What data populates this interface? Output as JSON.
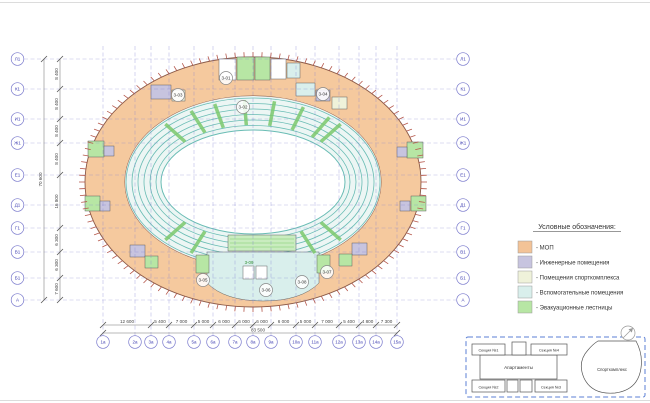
{
  "plan": {
    "rows": [
      {
        "label": "Л1",
        "y": 59
      },
      {
        "label": "К1",
        "y": 89
      },
      {
        "label": "И1",
        "y": 119
      },
      {
        "label": "Ж1",
        "y": 143
      },
      {
        "label": "Е1",
        "y": 175
      },
      {
        "label": "Д1",
        "y": 205
      },
      {
        "label": "Г1",
        "y": 228
      },
      {
        "label": "В1",
        "y": 252
      },
      {
        "label": "Б1",
        "y": 278
      },
      {
        "label": "А",
        "y": 300
      }
    ],
    "cols": [
      {
        "label": "1а",
        "x": 103
      },
      {
        "label": "2а",
        "x": 135
      },
      {
        "label": "3а",
        "x": 151
      },
      {
        "label": "4а",
        "x": 169
      },
      {
        "label": "5а",
        "x": 194
      },
      {
        "label": "6а",
        "x": 213
      },
      {
        "label": "7а",
        "x": 235
      },
      {
        "label": "8а",
        "x": 253
      },
      {
        "label": "9а",
        "x": 271
      },
      {
        "label": "10а",
        "x": 296
      },
      {
        "label": "11а",
        "x": 315
      },
      {
        "label": "12а",
        "x": 339
      },
      {
        "label": "13а",
        "x": 359
      },
      {
        "label": "14а",
        "x": 376
      },
      {
        "label": "15а",
        "x": 397
      }
    ],
    "left_dims": [
      {
        "text": "8 400",
        "y1": 59,
        "y2": 89
      },
      {
        "text": "8 400",
        "y1": 89,
        "y2": 119
      },
      {
        "text": "8 400",
        "y1": 119,
        "y2": 143
      },
      {
        "text": "8 400",
        "y1": 143,
        "y2": 175
      },
      {
        "text": "16 800",
        "y1": 175,
        "y2": 228
      },
      {
        "text": "6 300",
        "y1": 228,
        "y2": 252
      },
      {
        "text": "6 300",
        "y1": 252,
        "y2": 278
      },
      {
        "text": "7 600",
        "y1": 278,
        "y2": 300
      }
    ],
    "left_total": {
      "text": "70 600",
      "y1": 59,
      "y2": 300
    },
    "bottom_dims": [
      {
        "text": "12 600",
        "x1": 103,
        "x2": 151
      },
      {
        "text": "5 400",
        "x1": 151,
        "x2": 169
      },
      {
        "text": "7 000",
        "x1": 169,
        "x2": 194
      },
      {
        "text": "5 000",
        "x1": 194,
        "x2": 213
      },
      {
        "text": "6 000",
        "x1": 213,
        "x2": 235
      },
      {
        "text": "6 000",
        "x1": 235,
        "x2": 253
      },
      {
        "text": "6 000",
        "x1": 253,
        "x2": 271
      },
      {
        "text": "6 000",
        "x1": 271,
        "x2": 296
      },
      {
        "text": "5 000",
        "x1": 296,
        "x2": 315
      },
      {
        "text": "7 000",
        "x1": 315,
        "x2": 339
      },
      {
        "text": "5 400",
        "x1": 339,
        "x2": 359
      },
      {
        "text": "4 800",
        "x1": 359,
        "x2": 376
      },
      {
        "text": "7 300",
        "x1": 376,
        "x2": 397
      }
    ],
    "bottom_total": {
      "text": "83 500",
      "x1": 103,
      "x2": 397
    },
    "rooms": [
      {
        "id": "3-01",
        "x": 226,
        "y": 78
      },
      {
        "id": "3-02",
        "x": 243,
        "y": 107
      },
      {
        "id": "3-03",
        "x": 178,
        "y": 95
      },
      {
        "id": "3-04",
        "x": 323,
        "y": 94
      },
      {
        "id": "3-05",
        "x": 203,
        "y": 280
      },
      {
        "id": "3-06",
        "x": 266,
        "y": 290
      },
      {
        "id": "3-07",
        "x": 327,
        "y": 272
      },
      {
        "id": "3-08",
        "x": 302,
        "y": 282
      }
    ],
    "tribune_label": "3-09"
  },
  "legend": {
    "title": "Условные обозначения:",
    "items": [
      {
        "label": "- МОП",
        "color": "#f3c397"
      },
      {
        "label": "- Инженерные помещения",
        "color": "#c7c4df"
      },
      {
        "label": "- Помещения спорткомплекса",
        "color": "#eff2da"
      },
      {
        "label": "- Вспомогательные помещения",
        "color": "#d9efec"
      },
      {
        "label": "- Эвакуационные лестницы",
        "color": "#b7e6a4"
      }
    ]
  },
  "keyplan": {
    "apartments": "Апартаменты",
    "sections": [
      "Секция №1",
      "Секция №4",
      "Секция №2",
      "Секция №3"
    ],
    "sport": "Спорткомплекс"
  }
}
